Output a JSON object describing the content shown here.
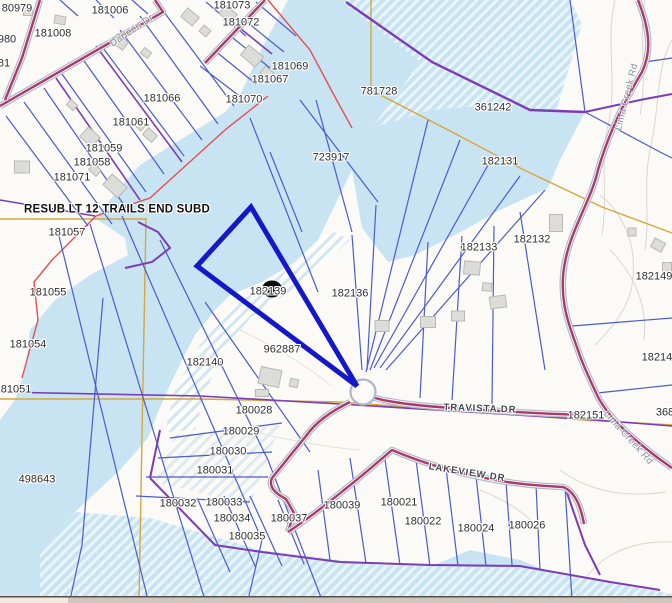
{
  "map": {
    "type": "parcel-gis-map",
    "highlighted_parcel_id": "182139",
    "subdivision_note": "RESUB LT 12 TRAILS END SUBD",
    "streets": [
      "Darleen Dr",
      "Lima Creek Rd",
      "Travista Dr",
      "Lakeview Dr"
    ],
    "marker_on_parcel": "182139",
    "colors": {
      "water": "#c8e4f2",
      "land": "#fbfaf7",
      "parcel_line": "#4a5ccc",
      "subdivision_line": "#7b3cb8",
      "road_center": "#a93a6e",
      "road_casing": "#aeb8c6",
      "survey_line": "#d6a63f",
      "boundary_red": "#e25050",
      "highlight": "#1518c8",
      "label": "#2e2e2e",
      "road_label_minor": "#8b8f9b",
      "road_label_major": "#42464e",
      "edge_strip": "#cfc6bd"
    },
    "labels": [
      {
        "kind": "parcel",
        "text": "80979",
        "x": 17,
        "y": 9
      },
      {
        "kind": "parcel",
        "text": "181006",
        "x": 110,
        "y": 11
      },
      {
        "kind": "parcel",
        "text": "181073",
        "x": 232,
        "y": 6
      },
      {
        "kind": "parcel",
        "text": "181072",
        "x": 241,
        "y": 23
      },
      {
        "kind": "parcel",
        "text": "181008",
        "x": 53,
        "y": 34
      },
      {
        "kind": "parcel",
        "text": "980",
        "x": 7,
        "y": 40
      },
      {
        "kind": "parcel",
        "text": "81",
        "x": 4,
        "y": 64
      },
      {
        "kind": "parcel",
        "text": "181069",
        "x": 290,
        "y": 67
      },
      {
        "kind": "parcel",
        "text": "181067",
        "x": 270,
        "y": 80
      },
      {
        "kind": "parcel",
        "text": "781728",
        "x": 379,
        "y": 92
      },
      {
        "kind": "parcel",
        "text": "181066",
        "x": 162,
        "y": 99
      },
      {
        "kind": "parcel",
        "text": "181070",
        "x": 244,
        "y": 100
      },
      {
        "kind": "parcel",
        "text": "361242",
        "x": 493,
        "y": 108
      },
      {
        "kind": "parcel",
        "text": "181061",
        "x": 131,
        "y": 123
      },
      {
        "kind": "parcel",
        "text": "181059",
        "x": 104,
        "y": 149
      },
      {
        "kind": "parcel",
        "text": "723917",
        "x": 331,
        "y": 158
      },
      {
        "kind": "parcel",
        "text": "182131",
        "x": 500,
        "y": 162
      },
      {
        "kind": "parcel",
        "text": "181058",
        "x": 92,
        "y": 163
      },
      {
        "kind": "parcel",
        "text": "181071",
        "x": 72,
        "y": 178
      },
      {
        "kind": "subdivision",
        "text": "RESUB LT 12 TRAILS END SUBD",
        "x": 117,
        "y": 210
      },
      {
        "kind": "parcel",
        "text": "181057",
        "x": 67,
        "y": 233
      },
      {
        "kind": "parcel",
        "text": "182132",
        "x": 532,
        "y": 240
      },
      {
        "kind": "parcel",
        "text": "182133",
        "x": 479,
        "y": 248
      },
      {
        "kind": "parcel",
        "text": "182149",
        "x": 654,
        "y": 277
      },
      {
        "kind": "parcel",
        "text": "181055",
        "x": 48,
        "y": 293
      },
      {
        "kind": "parcel",
        "text": "182139",
        "x": 268,
        "y": 292
      },
      {
        "kind": "parcel",
        "text": "182136",
        "x": 350,
        "y": 294
      },
      {
        "kind": "parcel",
        "text": "181054",
        "x": 28,
        "y": 345
      },
      {
        "kind": "parcel",
        "text": "962887",
        "x": 282,
        "y": 350
      },
      {
        "kind": "parcel",
        "text": "182140",
        "x": 205,
        "y": 363
      },
      {
        "kind": "parcel",
        "text": "182148",
        "x": 660,
        "y": 358
      },
      {
        "kind": "parcel",
        "text": "181051",
        "x": 13,
        "y": 390
      },
      {
        "kind": "parcel",
        "text": "182151",
        "x": 586,
        "y": 416
      },
      {
        "kind": "parcel",
        "text": "368",
        "x": 665,
        "y": 413
      },
      {
        "kind": "parcel",
        "text": "180028",
        "x": 254,
        "y": 411
      },
      {
        "kind": "parcel",
        "text": "180029",
        "x": 241,
        "y": 432
      },
      {
        "kind": "parcel",
        "text": "180030",
        "x": 228,
        "y": 452
      },
      {
        "kind": "parcel",
        "text": "180031",
        "x": 215,
        "y": 471
      },
      {
        "kind": "parcel",
        "text": "498643",
        "x": 37,
        "y": 480
      },
      {
        "kind": "parcel",
        "text": "180032",
        "x": 178,
        "y": 504
      },
      {
        "kind": "parcel",
        "text": "180033",
        "x": 224,
        "y": 503
      },
      {
        "kind": "parcel",
        "text": "180039",
        "x": 342,
        "y": 506
      },
      {
        "kind": "parcel",
        "text": "180021",
        "x": 399,
        "y": 503
      },
      {
        "kind": "parcel",
        "text": "180034",
        "x": 232,
        "y": 519
      },
      {
        "kind": "parcel",
        "text": "180037",
        "x": 289,
        "y": 519
      },
      {
        "kind": "parcel",
        "text": "180022",
        "x": 423,
        "y": 522
      },
      {
        "kind": "parcel",
        "text": "180035",
        "x": 247,
        "y": 537
      },
      {
        "kind": "parcel",
        "text": "180024",
        "x": 476,
        "y": 529
      },
      {
        "kind": "parcel",
        "text": "180026",
        "x": 527,
        "y": 526
      },
      {
        "kind": "road-minor",
        "text": "Darleen Dr",
        "x": 132,
        "y": 31,
        "angle": -34
      },
      {
        "kind": "road-minor",
        "text": "Lima Creek Rd",
        "x": 627,
        "y": 97,
        "angle": -76
      },
      {
        "kind": "road-minor",
        "text": "Lima Creek Rd",
        "x": 628,
        "y": 438,
        "angle": 48
      },
      {
        "kind": "road-major",
        "text": "TRAVISTA DR",
        "x": 480,
        "y": 409,
        "angle": 2
      },
      {
        "kind": "road-major",
        "text": "LAKEVIEW DR",
        "x": 467,
        "y": 473,
        "angle": 9
      }
    ]
  }
}
